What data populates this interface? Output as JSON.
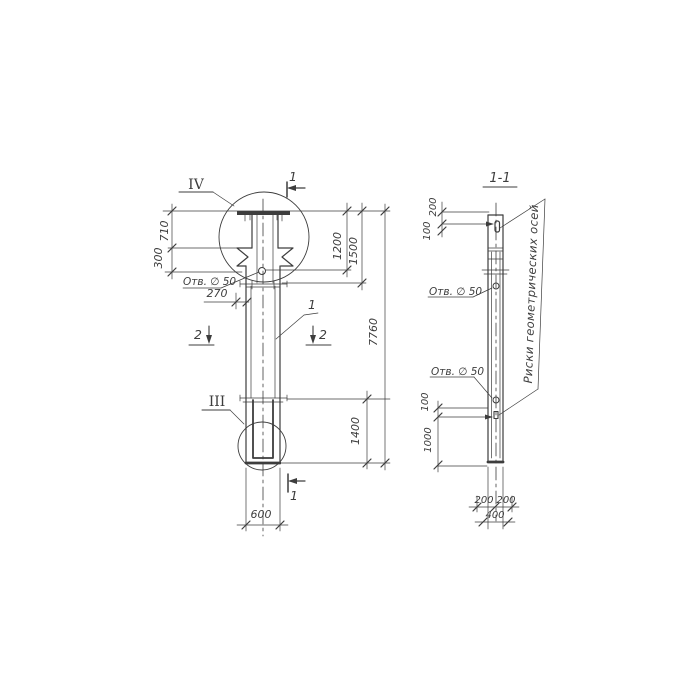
{
  "colors": {
    "ink": "#3d3d3d",
    "paper": "#ffffff"
  },
  "front_view": {
    "dims": {
      "top_710": "710",
      "collar_300": "300",
      "hole_270": "270",
      "to_hole_1200": "1200",
      "head_1500": "1500",
      "total_7760": "7760",
      "bottom_1400": "1400",
      "width_600": "600"
    },
    "hole_note": "Отв. ∅ 50",
    "detail_top": "IV",
    "detail_bottom": "III",
    "section_mark_1": "1",
    "section_mark_2": "2",
    "part_label": "1"
  },
  "section_view": {
    "title": "1-1",
    "dims": {
      "top_200": "200",
      "top_100": "100",
      "mid_100": "100",
      "mid_1000": "1000",
      "bottom_200_left": "200",
      "bottom_200_right": "200",
      "bottom_400": "400"
    },
    "hole_note_upper": "Отв. ∅ 50",
    "hole_note_lower": "Отв. ∅ 50",
    "axes_note": "Риски геометрических осей"
  }
}
